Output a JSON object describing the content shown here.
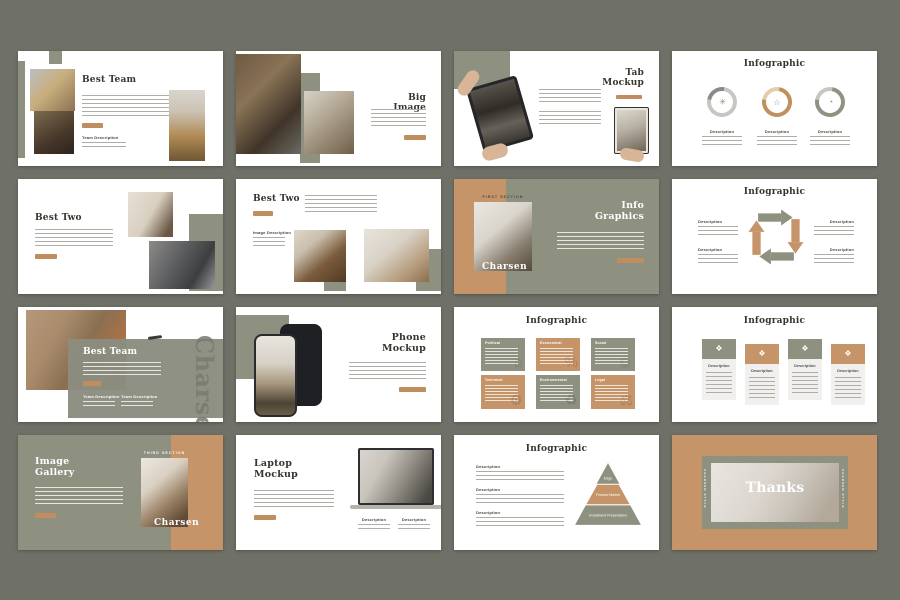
{
  "page": {
    "background": "#6f7067"
  },
  "colors": {
    "olive": "#8e9080",
    "tan": "#c59468",
    "button": "#c08d5e",
    "title_dark": "#37352d"
  },
  "common": {
    "description_label": "Description",
    "team_description_label": "Team Description",
    "image_description_label": "Image Description",
    "brand": "Charsen"
  },
  "icons": {
    "donut_gear": "✳",
    "donut_star": "☆",
    "donut_pie": "◔",
    "box_political": "⌂",
    "box_economical": "%",
    "box_social": "☺",
    "box_technical": "⚙",
    "box_environmental": "♻",
    "box_legal": "⚖",
    "card_ornament": "❖"
  },
  "slides": [
    {
      "title": "Best Team"
    },
    {
      "title": "Big Image"
    },
    {
      "title": "Tab Mockup"
    },
    {
      "title": "Infographic"
    },
    {
      "title": "Best Two"
    },
    {
      "title": "Best Two"
    },
    {
      "title": "Info Graphics",
      "section": "First Section"
    },
    {
      "title": "Infographic"
    },
    {
      "title": "Best Team"
    },
    {
      "title": "Phone Mockup"
    },
    {
      "title": "Infographic",
      "boxes": [
        "Political",
        "Economical",
        "Social",
        "Technical",
        "Environmental",
        "Legal"
      ]
    },
    {
      "title": "Infographic"
    },
    {
      "title": "Image Gallery",
      "section": "Third Section"
    },
    {
      "title": "Laptop Mockup"
    },
    {
      "title": "Infographic",
      "pyramid": [
        "Edge",
        "Finance Market",
        "Investment Presentation"
      ]
    },
    {
      "title": "Thanks",
      "side_caption": "Charsen Style"
    }
  ]
}
